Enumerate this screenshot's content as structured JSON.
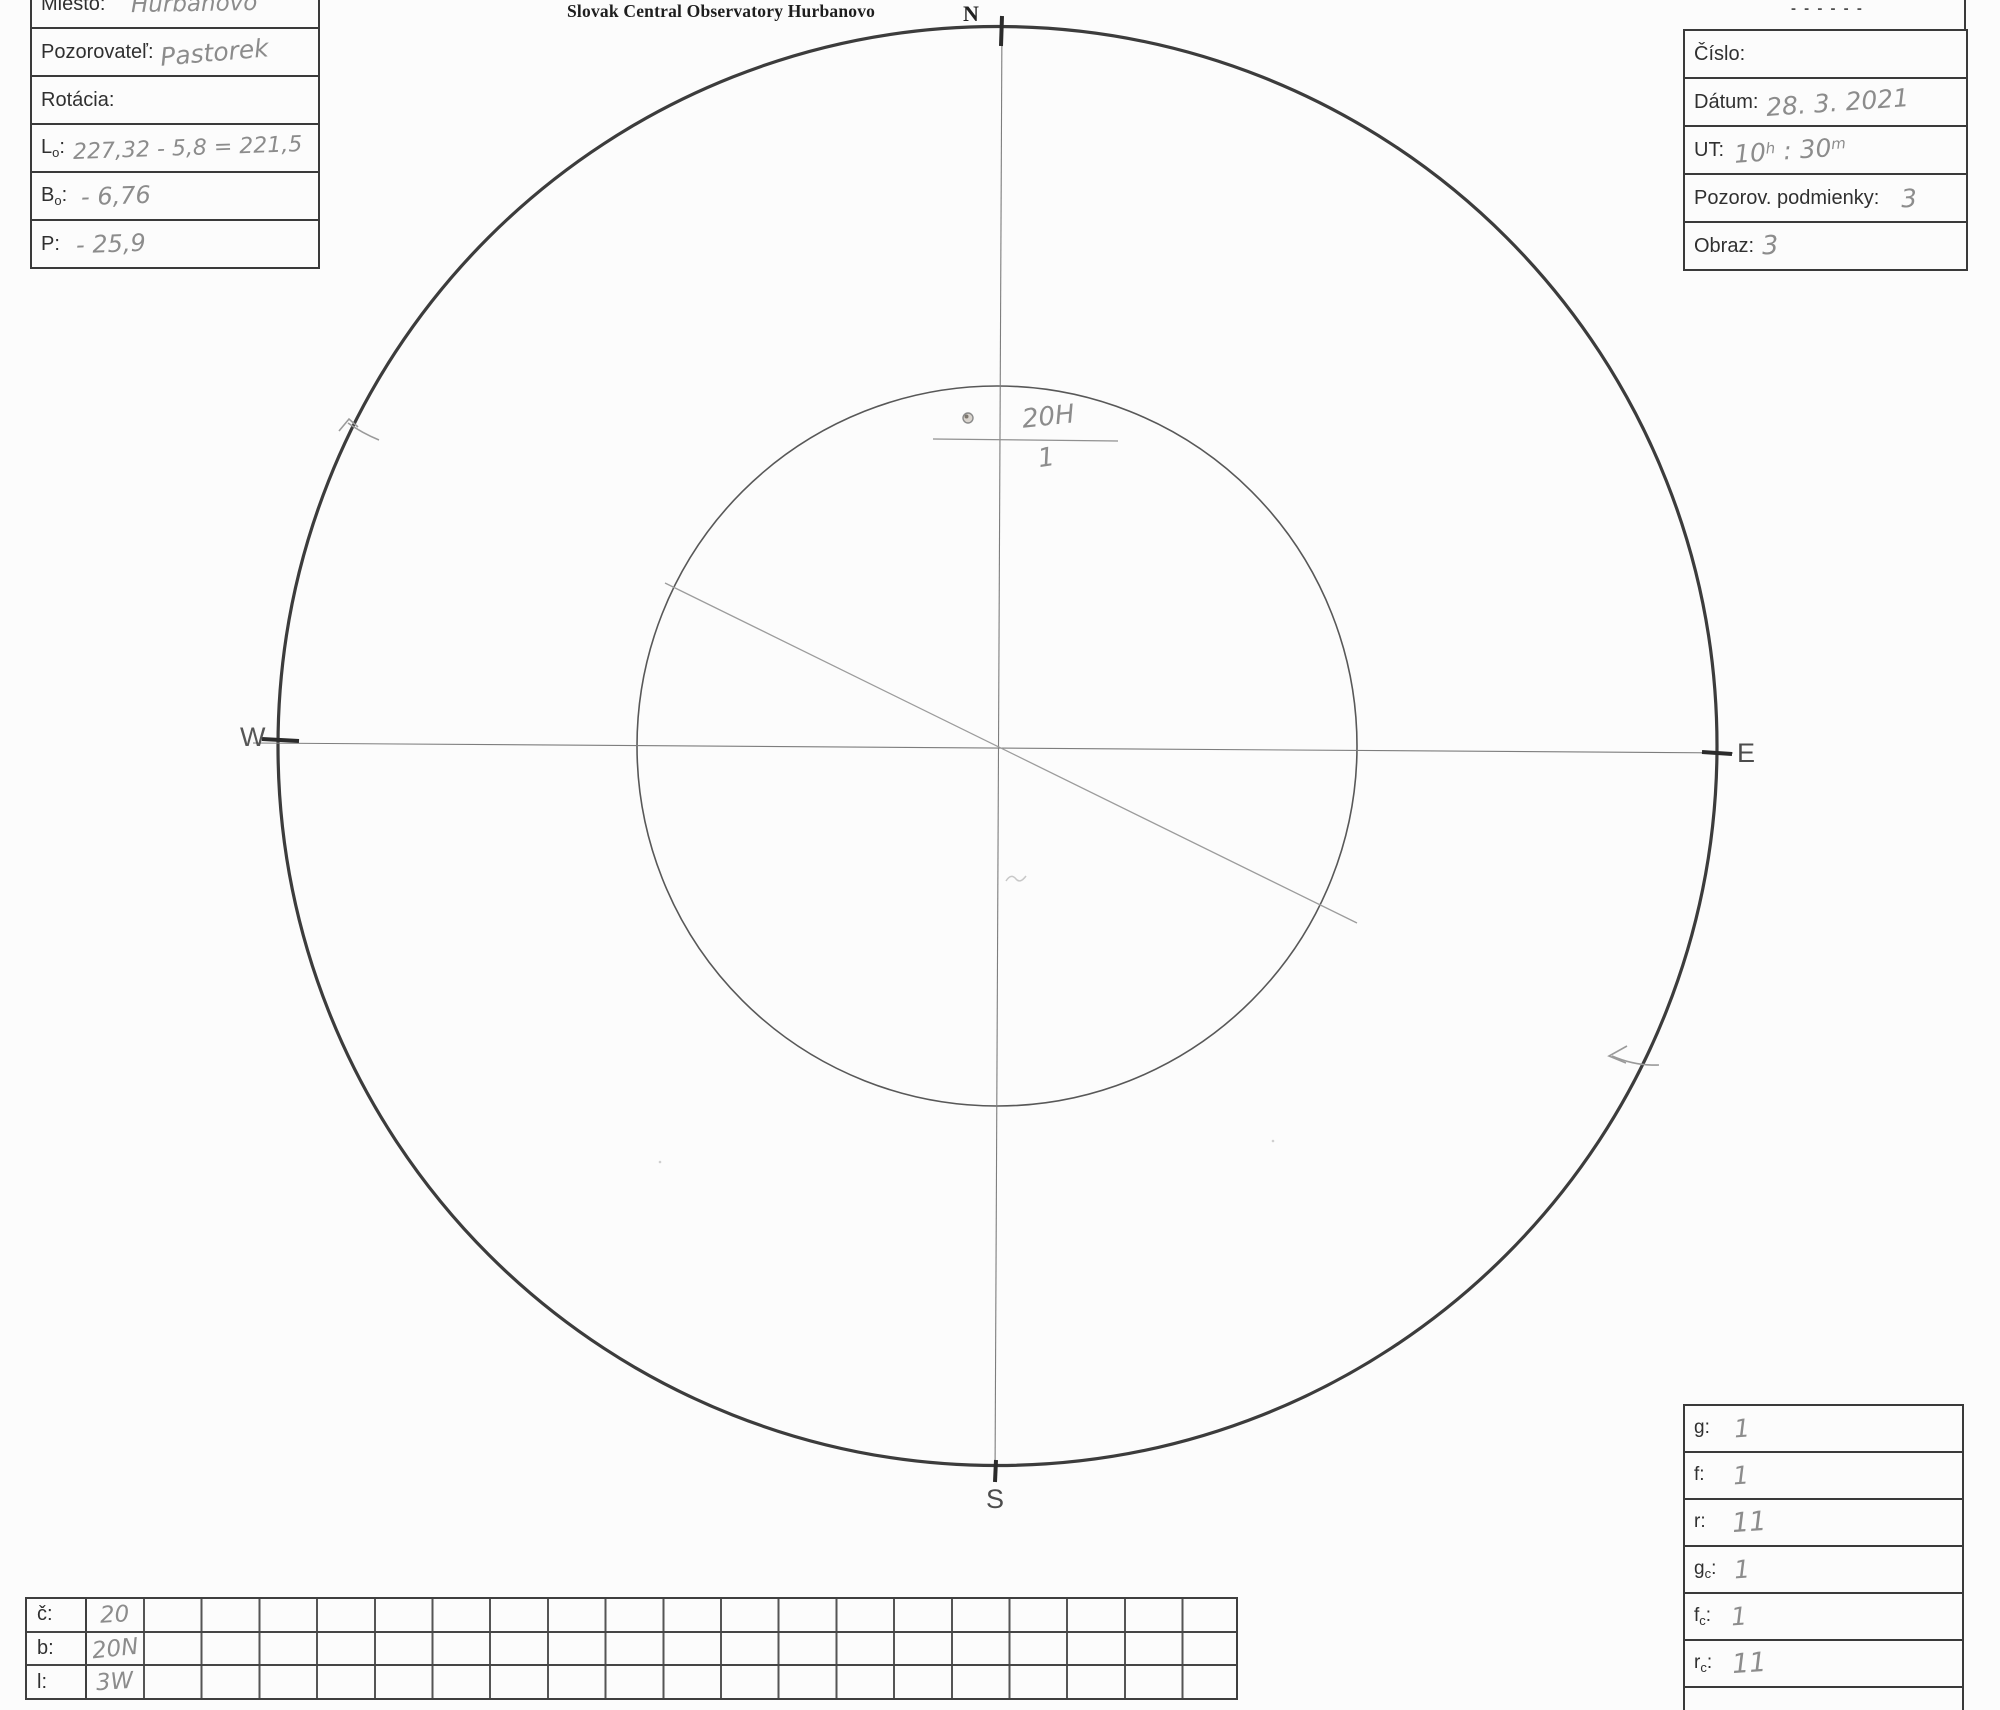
{
  "title": "Slovak Central Observatory Hurbanovo",
  "left_form": {
    "rows": [
      {
        "label": "Miesto:",
        "value": "Hurbanovo"
      },
      {
        "label": "Pozorovateľ:",
        "value": "Pastorek"
      },
      {
        "label": "Rotácia:",
        "value": ""
      },
      {
        "label_main": "L",
        "label_sub": "o",
        "label_suffix": ":",
        "value": "227,32 - 5,8 = 221,5"
      },
      {
        "label_main": "B",
        "label_sub": "o",
        "label_suffix": ":",
        "value": "- 6,76"
      },
      {
        "label": "P:",
        "value": "- 25,9"
      }
    ]
  },
  "right_form": {
    "remnant": "- - - - - -",
    "rows": [
      {
        "label": "Číslo:",
        "value": ""
      },
      {
        "label": "Dátum:",
        "value": "28. 3. 2021"
      },
      {
        "label": "UT:",
        "value": ""
      },
      {
        "label": "Pozorov. podmienky:",
        "value": "3"
      },
      {
        "label": "Obraz:",
        "value": "3"
      }
    ],
    "ut_parts": {
      "hours": "10",
      "h_unit": "h",
      "sep": " : 30",
      "m_unit": "m"
    }
  },
  "compass": {
    "north": "N",
    "south": "S",
    "east": "E",
    "west": "W"
  },
  "sunspot_annotation": {
    "group_label": "20H",
    "spot_count": "1"
  },
  "stats_form": {
    "rows": [
      {
        "label_main": "g",
        "label_sub": "",
        "label_suffix": ":",
        "value": "1"
      },
      {
        "label_main": "f",
        "label_sub": "",
        "label_suffix": ":",
        "value": "1"
      },
      {
        "label_main": "r",
        "label_sub": "",
        "label_suffix": ":",
        "value": "11"
      },
      {
        "label_main": "g",
        "label_sub": "c",
        "label_suffix": ":",
        "value": "1"
      },
      {
        "label_main": "f",
        "label_sub": "c",
        "label_suffix": ":",
        "value": "1"
      },
      {
        "label_main": "r",
        "label_sub": "c",
        "label_suffix": ":",
        "value": "11"
      }
    ]
  },
  "positions_table": {
    "rows": [
      {
        "label": "č:",
        "value": "20"
      },
      {
        "label": "b:",
        "value": "20N"
      },
      {
        "label": "l:",
        "value": "3W"
      }
    ]
  }
}
